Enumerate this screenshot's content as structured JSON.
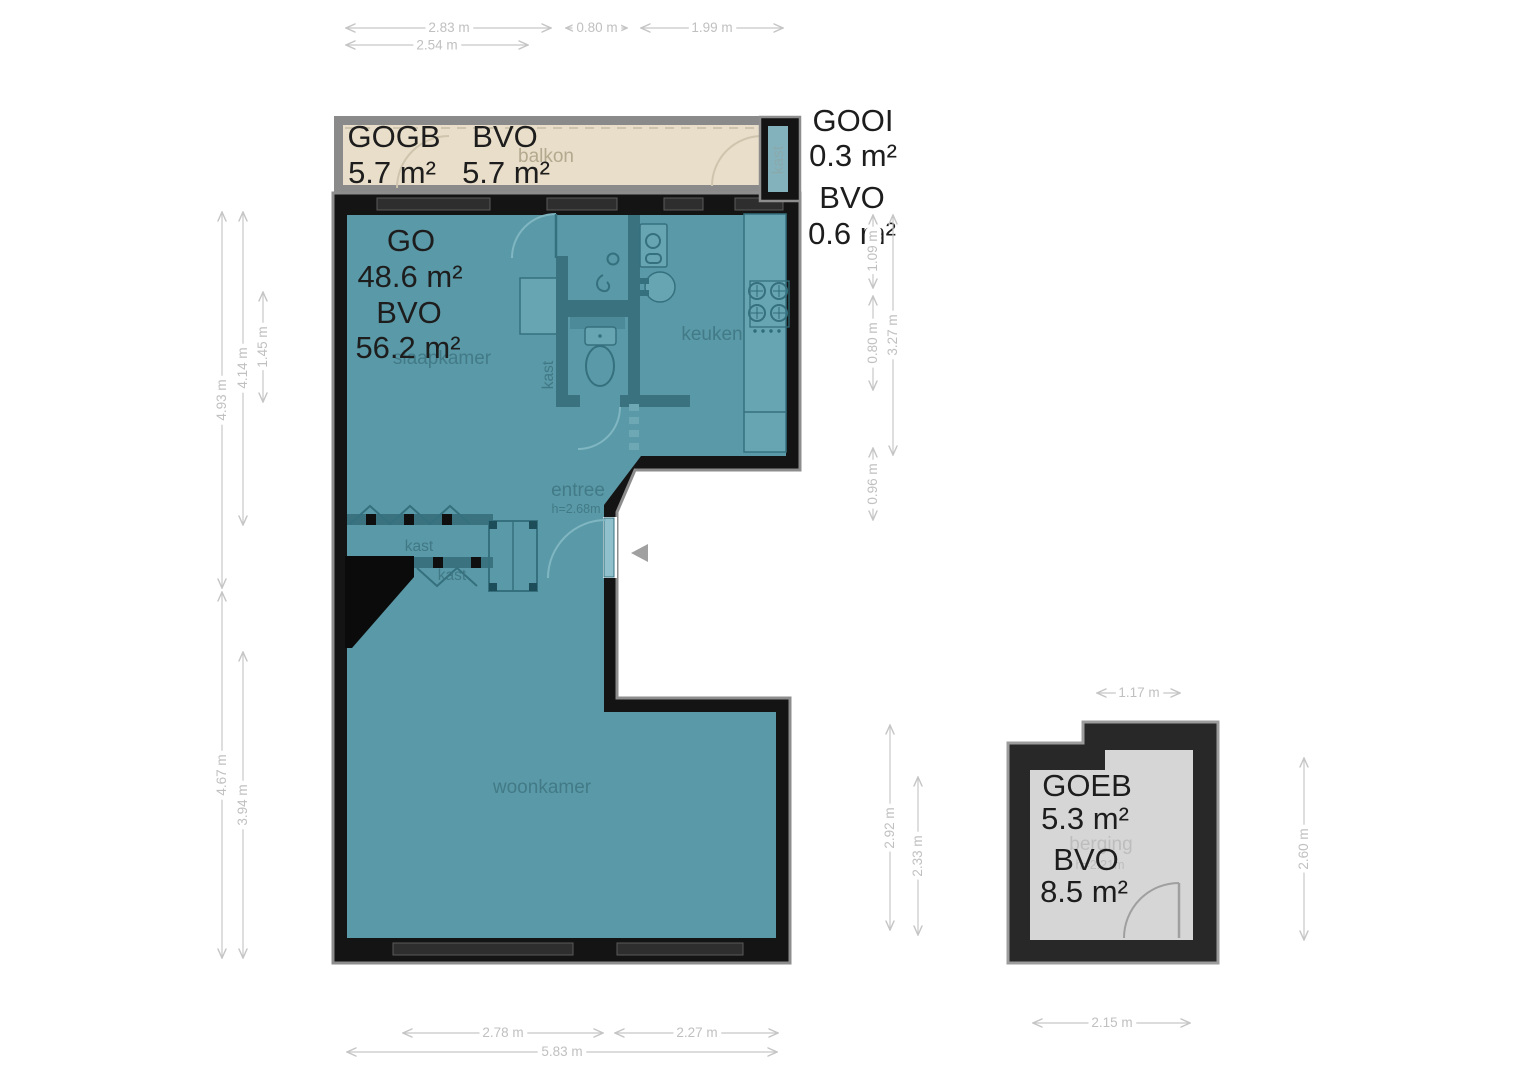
{
  "plan": {
    "areas": {
      "balcony": {
        "code": "GOGB",
        "area": "5.7 m²",
        "bvo_code": "BVO",
        "bvo": "5.7 m²"
      },
      "outdoor_closet": {
        "code": "GOOI",
        "area": "0.3 m²",
        "bvo_code": "BVO",
        "bvo": "0.6 m²"
      },
      "apartment": {
        "code": "GO",
        "area": "48.6 m²",
        "bvo_code": "BVO",
        "bvo": "56.2 m²"
      },
      "storage": {
        "code": "GOEB",
        "area": "5.3 m²",
        "bvo_code": "BVO",
        "bvo": "8.5 m²"
      }
    },
    "rooms": {
      "balcony": "balkon",
      "bedroom": "slaapkamer",
      "kitchen": "keuken",
      "hall": "entree",
      "hall_height": "h=2.68m",
      "living_room": "woonkamer",
      "storage": "berging",
      "storage_height": "h=2.21m",
      "closet": "kast"
    },
    "dimensions": {
      "top": [
        "2.83 m",
        "0.80 m",
        "1.99 m",
        "2.54 m"
      ],
      "left": [
        "4.93 m",
        "4.14 m",
        "1.45 m",
        "4.67 m",
        "3.94 m"
      ],
      "right": [
        "1.09 m",
        "0.80 m",
        "0.96 m",
        "3.27 m"
      ],
      "bottom": [
        "2.78 m",
        "2.27 m",
        "5.83 m"
      ],
      "storage": [
        "1.17 m",
        "2.92 m",
        "2.33 m",
        "2.60 m",
        "2.15 m"
      ]
    },
    "colors": {
      "floor_teal": "#5a99a7",
      "partition_teal": "#3a7280",
      "wall_black": "#141414",
      "wall_outline": "#8d8d8d",
      "balcony_beige": "#e9dec9",
      "balcony_wall": "#8a8a8a",
      "storage_floor": "#d6d6d6",
      "storage_wall": "#282828",
      "dimension_gray": "#c5c5c5",
      "label_dark": "#1d1d1d"
    }
  }
}
